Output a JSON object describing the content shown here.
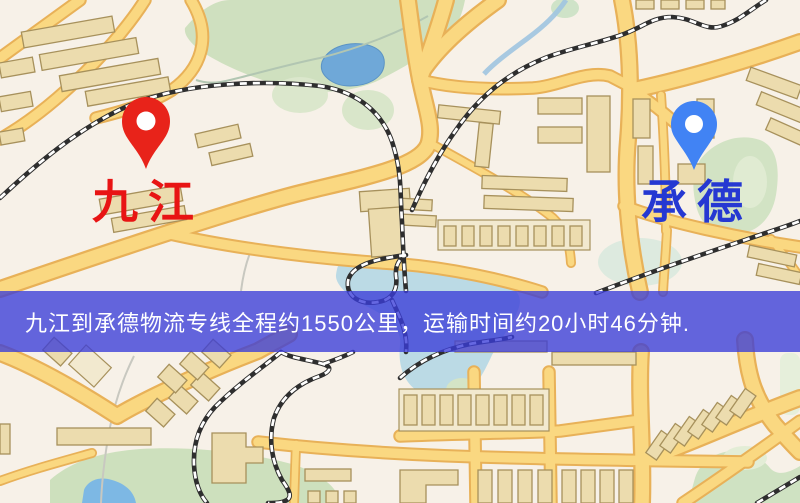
{
  "map": {
    "origin_marker": {
      "label": "九江",
      "label_color": "#e81414",
      "pin_color": "#e8231a"
    },
    "destination_marker": {
      "label": "承德",
      "label_color": "#2538d2",
      "pin_color": "#4183f4"
    }
  },
  "banner": {
    "text": "九江到承德物流专线全程约1550公里，运输时间约20小时46分钟.",
    "background_color": "#3a3cd8",
    "text_color": "#ffffff"
  },
  "palette": {
    "map_background": "#f7f1e8",
    "road_fill": "#fad881",
    "road_casing": "#e8b158",
    "park_green": "#cfe0bf",
    "water_blue": "#6fa8d8",
    "building_fill": "#ecdcae",
    "building_outline": "#a7915c",
    "railway_dark": "#2e2e2e"
  }
}
